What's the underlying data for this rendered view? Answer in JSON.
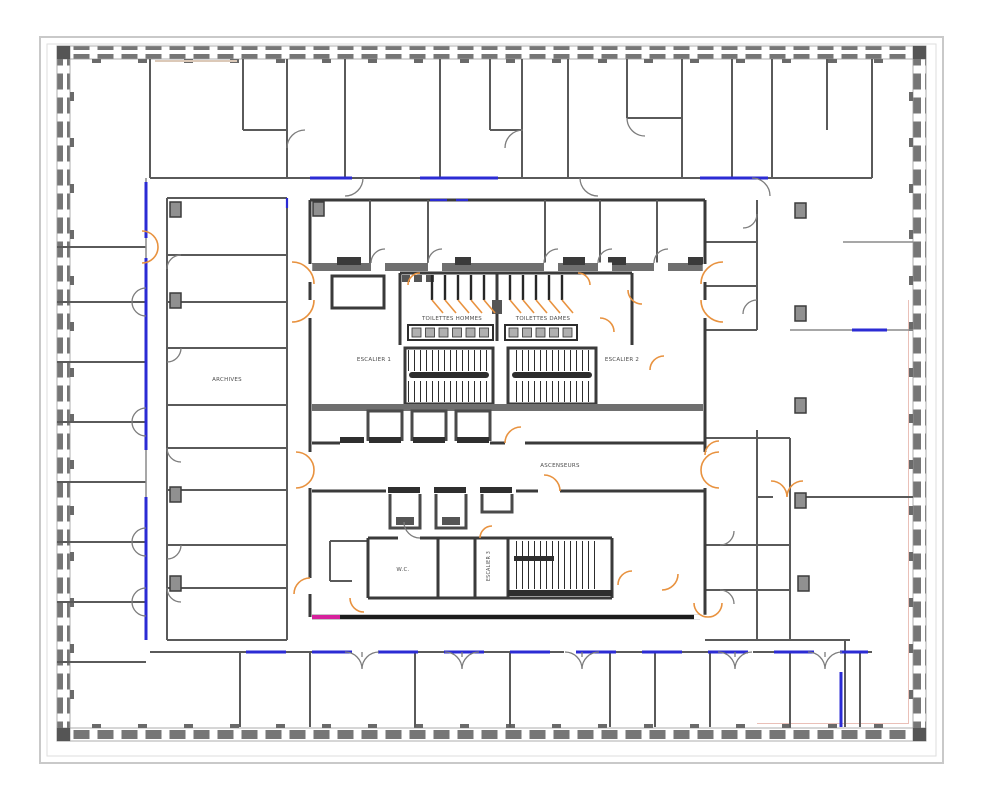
{
  "labels": {
    "toilets_left": "TOILETTES HOMMES",
    "toilets_right": "TOILETTES DAMES",
    "stair1": "ESCALIER 1",
    "stair2": "ESCALIER 2",
    "stair3": "ESCALIER 3",
    "elevators": "ASCENSEURS",
    "wc": "W.C.",
    "archives": "ARCHIVES"
  },
  "colors": {
    "wall": "#3a3a3a",
    "partition": "#5a5a5a",
    "door": "#e8923f",
    "glazing": "#2b2bd4",
    "magenta": "#d6219c",
    "hatch": "#767676",
    "frame": "#c9c9c9",
    "tan": "#dcc9b8",
    "text": "#4c4c4c"
  }
}
